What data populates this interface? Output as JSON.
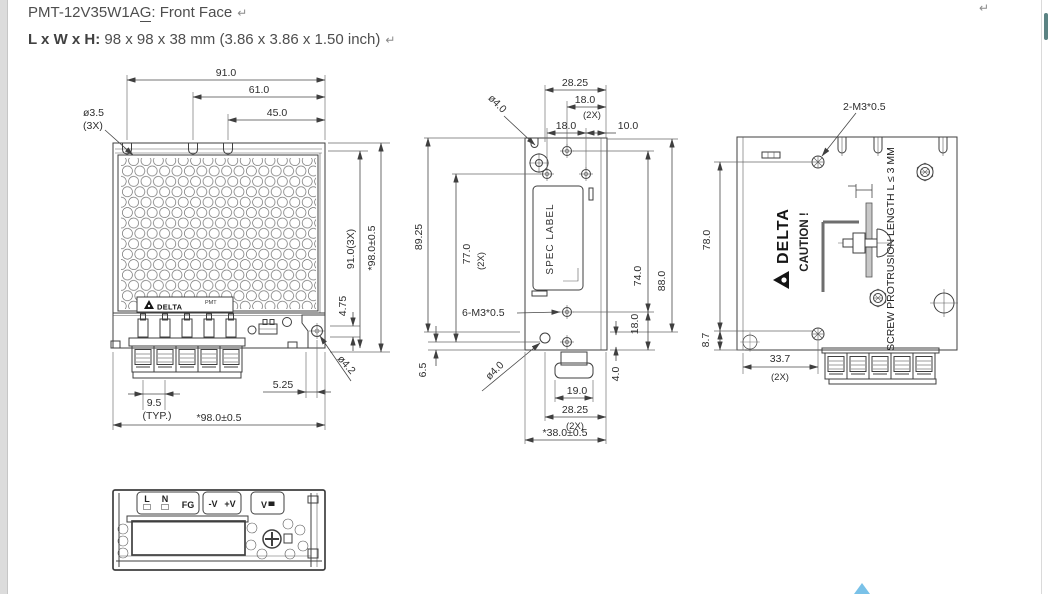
{
  "document": {
    "title_prefix": "PMT-12V35W1A",
    "title_underlined": "G",
    "title_suffix": ": Front Face",
    "return_mark": "↵",
    "size_label": "L x W x H:",
    "size_value": " 98 x 98 x 38 mm (3.86 x 3.86 x 1.50 inch)"
  },
  "front_view": {
    "dim_width_outer": "91.0",
    "dim_width_mid": "61.0",
    "dim_width_inner": "45.0",
    "hole_dia_top": "ø3.5",
    "hole_dia_top_qty": "(3X)",
    "dim_height_holes": "91.0(3X)",
    "dim_overall": "*98.0±0.5",
    "dim_foot": "4.75",
    "hole_dia_corner": "ø4.2",
    "dim_terminal_pitch": "9.5",
    "terminal_pitch_note": "(TYP.)",
    "dim_corner_offset": "5.25",
    "brand": "DELTA",
    "series": "PMT"
  },
  "side_view": {
    "dim_2825": "28.25",
    "dim_18_top": "18.0",
    "qty_2x": "(2X)",
    "dim_18_mid": "18.0",
    "dim_10": "10.0",
    "hole_dia_notch": "ø4.0",
    "dim_8925": "89.25",
    "dim_77": "77.0",
    "spec_label": "SPEC LABEL",
    "dim_74": "74.0",
    "dim_88": "88.0",
    "dim_18_right": "18.0",
    "dim_4": "4.0",
    "thread_note": "6-M3*0.5",
    "hole_dia_bottom": "ø4.0",
    "dim_65": "6.5",
    "dim_19": "19.0",
    "dim_2825_bottom": "28.25",
    "dim_depth_overall": "*38.0±0.5"
  },
  "back_view": {
    "thread_note": "2-M3*0.5",
    "dim_78": "78.0",
    "dim_87": "8.7",
    "dim_337": "33.7",
    "qty_2x": "(2X)",
    "brand": "DELTA",
    "caution": "CAUTION !",
    "protrusion_note": "SCREW PROTRUSION LENGTH  L ≤ 3 MM"
  },
  "bottom_view": {
    "terminal_l": "L",
    "terminal_n": "N",
    "terminal_fg": "FG",
    "terminal_neg_v": "-V",
    "terminal_pos_v": "+V",
    "terminal_vadj": "V"
  },
  "colors": {
    "anchor_marker": "#79c1e8",
    "scrollbar_thumb": "#5b8383",
    "line": "#3f3f3f"
  }
}
